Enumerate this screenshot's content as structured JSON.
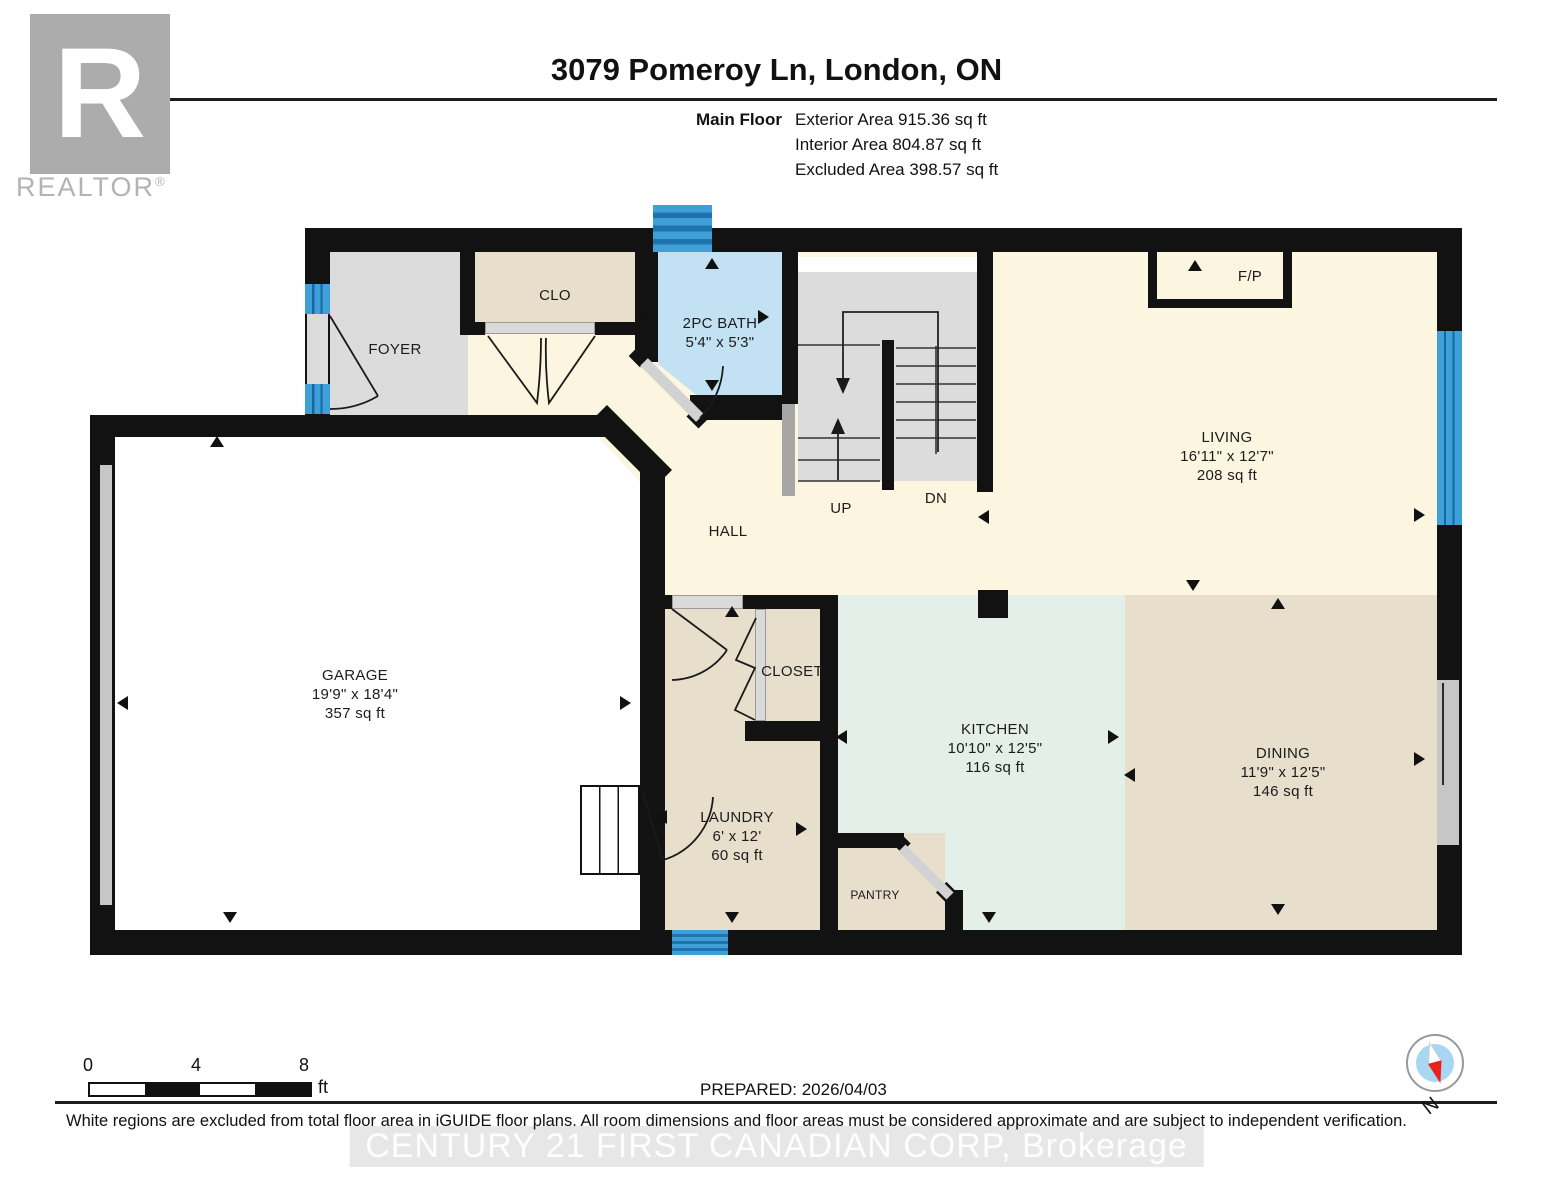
{
  "header": {
    "title": "3079 Pomeroy Ln, London, ON",
    "floor_label": "Main Floor",
    "exterior": "Exterior Area 915.36 sq ft",
    "interior": "Interior Area 804.87 sq ft",
    "excluded": "Excluded Area 398.57 sq ft"
  },
  "logo": {
    "r": "R",
    "name": "REALTOR",
    "reg": "®"
  },
  "rooms": {
    "foyer": {
      "name": "FOYER"
    },
    "clo": {
      "name": "CLO"
    },
    "bath": {
      "name": "2PC BATH",
      "dims": "5'4\" x 5'3\""
    },
    "living": {
      "name": "LIVING",
      "dims": "16'11\" x 12'7\"",
      "area": "208 sq ft"
    },
    "hall": {
      "name": "HALL"
    },
    "garage": {
      "name": "GARAGE",
      "dims": "19'9\" x 18'4\"",
      "area": "357 sq ft"
    },
    "closet": {
      "name": "CLOSET"
    },
    "laundry": {
      "name": "LAUNDRY",
      "dims": "6' x 12'",
      "area": "60 sq ft"
    },
    "pantry": {
      "name": "PANTRY"
    },
    "kitchen": {
      "name": "KITCHEN",
      "dims": "10'10\" x 12'5\"",
      "area": "116 sq ft"
    },
    "dining": {
      "name": "DINING",
      "dims": "11'9\" x 12'5\"",
      "area": "146 sq ft"
    }
  },
  "stairs": {
    "up": "UP",
    "down": "DN"
  },
  "fireplace": {
    "label": "F/P"
  },
  "scale_bar": {
    "zero": "0",
    "four": "4",
    "eight": "8",
    "unit": "ft"
  },
  "footer": {
    "prepared": "PREPARED: 2026/04/03",
    "disclaimer": "White regions are excluded from total floor area in iGUIDE floor plans. All room dimensions and floor areas must be considered approximate and are subject to independent verification.",
    "watermark": "CENTURY 21 FIRST CANADIAN CORP, Brokerage"
  },
  "compass": {
    "north": "N"
  },
  "colors": {
    "wall": "#121212",
    "cream": "#FCF5DF",
    "beige": "#E7DECC",
    "mint": "#E3EFE8",
    "room_gray": "#DCDCDC",
    "bath_blue": "#C2E2F4",
    "window_blue": "#3FA0D9",
    "window_dark": "#1F74AE",
    "garage_white": "#FFFFFF",
    "compass_red": "#E8211D",
    "compass_blue": "#A9D6F2"
  }
}
